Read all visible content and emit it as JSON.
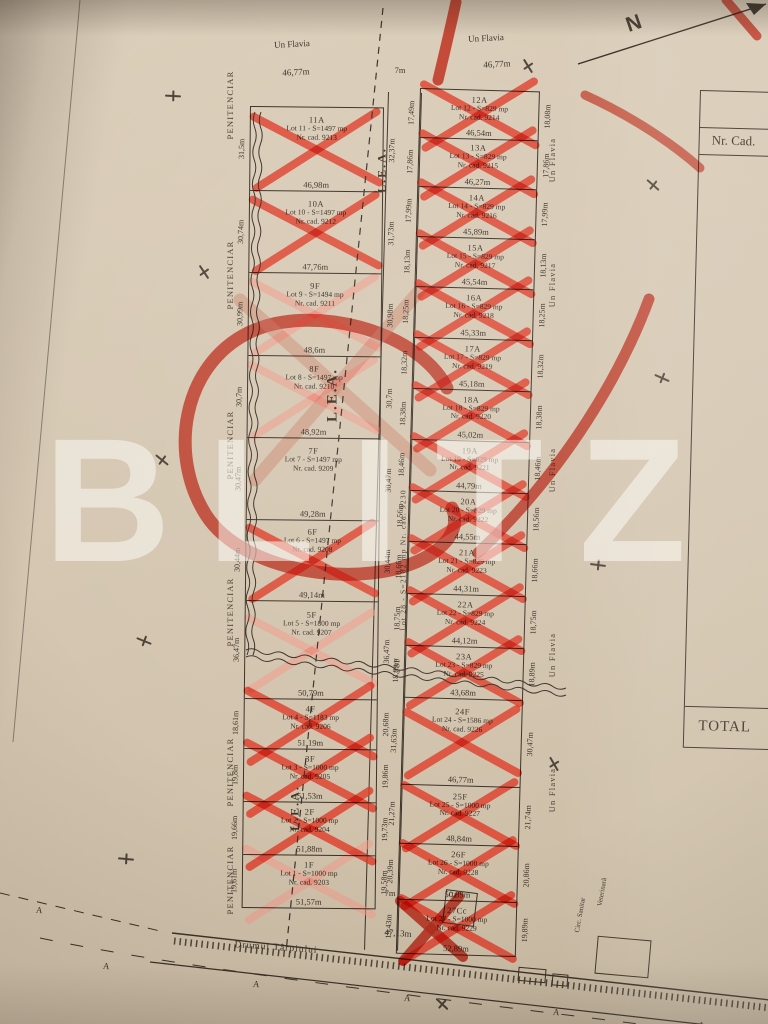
{
  "watermark": "BLITZ",
  "compass_label": "N",
  "colors": {
    "paper": "#d5c7b2",
    "ink": "#3b3127",
    "red": "#df3a28",
    "red_light": "#f29a8a"
  },
  "top": {
    "street_left": "Un Flavia",
    "street_right": "Un Flavia",
    "frontage_left": "46,77m",
    "frontage_right": "46,77m",
    "road_width_top": "7m"
  },
  "bottom": {
    "road_name": "Drumul Târpiului",
    "road_width_bottom": "7m",
    "frontage": "47,13m",
    "boundary_letter": "A",
    "building_label": "C1",
    "sanitary_label_1": "Circ. Sanitar",
    "sanitary_label_2": "Veterinară"
  },
  "margins": {
    "left_label": "PENITENCIAR",
    "right_label": "Un Flavia",
    "power_line_label": "L.E.A."
  },
  "road_lot": {
    "designation": "28F",
    "label": "Lot 28 - S=2182 mp Nr. cad. 9230"
  },
  "side_table": {
    "header": "Nr. Cad.",
    "footer": "TOTAL"
  },
  "left_column": [
    {
      "designation": "11A",
      "area": "Lot 11 - S=1497 mp",
      "cad": "Nr. cad. 9213",
      "frontage": "46,98m",
      "side_left": "31,5m",
      "side_right": "32,37m",
      "mark": "x"
    },
    {
      "designation": "10A",
      "area": "Lot 10 - S=1497 mp",
      "cad": "Nr. cad. 9212",
      "frontage": "47,76m",
      "side_left": "30,74m",
      "side_right": "31,73m",
      "mark": "x"
    },
    {
      "designation": "9F",
      "area": "Lot 9 - S=1494 mp",
      "cad": "Nr. cad. 9211",
      "frontage": "48,6m",
      "side_left": "30,99m",
      "side_right": "30,98m",
      "mark": "x-light"
    },
    {
      "designation": "8F",
      "area": "Lot 8 - S=1497 mp",
      "cad": "Nr. cad. 9210",
      "frontage": "48,92m",
      "side_left": "30,7m",
      "side_right": "30,7m",
      "mark": "x-light"
    },
    {
      "designation": "7F",
      "area": "Lot 7 - S=1497 mp",
      "cad": "Nr. cad. 9209",
      "frontage": "49,28m",
      "side_left": "30,47m",
      "side_right": "30,47m",
      "mark": "none"
    },
    {
      "designation": "6F",
      "area": "Lot 6 - S=1497 mp",
      "cad": "Nr. cad. 9208",
      "frontage": "49,14m",
      "side_left": "30,44m",
      "side_right": "30,44m",
      "mark": "x"
    },
    {
      "designation": "5F",
      "area": "Lot 5 - S=1800 mp",
      "cad": "Nr. cad. 9207",
      "frontage": "50,79m",
      "side_left": "36,47m",
      "side_right": "36,47m",
      "mark": "x-light"
    },
    {
      "designation": "4F",
      "area": "Lot 4 - S=1183 mp",
      "cad": "Nr. cad. 9206",
      "frontage": "51,19m",
      "side_left": "18,61m",
      "side_right": "20,68m",
      "mark": "x"
    },
    {
      "designation": "3F",
      "area": "Lot 3 - S=1000 mp",
      "cad": "Nr. cad. 9205",
      "frontage": "51,53m",
      "side_left": "19,8m",
      "side_right": "19,86m",
      "mark": "x"
    },
    {
      "designation": "2F",
      "area": "Lot 2 - S=1000 mp",
      "cad": "Nr. cad. 9204",
      "frontage": "51,88m",
      "side_left": "19,66m",
      "side_right": "19,73m",
      "mark": "x"
    },
    {
      "designation": "1F",
      "area": "Lot 1 - S=1000 mp",
      "cad": "Nr. cad. 9203",
      "frontage": "51,57m",
      "side_left": "19,61m",
      "side_right": "19,58m",
      "mark": "x-light"
    }
  ],
  "right_column": [
    {
      "designation": "12A",
      "area": "Lot 12 - S=829 mp",
      "cad": "Nr. cad. 9214",
      "frontage": "46,54m",
      "side_left": "17,49m",
      "side_right": "18,08m",
      "mark": "x"
    },
    {
      "designation": "13A",
      "area": "Lot 13 - S=829 mp",
      "cad": "Nr. cad. 9215",
      "frontage": "46,27m",
      "side_left": "17,86m",
      "side_right": "17,86m",
      "mark": "x"
    },
    {
      "designation": "14A",
      "area": "Lot 14 - S=829 mp",
      "cad": "Nr. cad. 9216",
      "frontage": "45,89m",
      "side_left": "17,99m",
      "side_right": "17,99m",
      "mark": "x"
    },
    {
      "designation": "15A",
      "area": "Lot 15 - S=829 mp",
      "cad": "Nr. cad. 9217",
      "frontage": "45,54m",
      "side_left": "18,13m",
      "side_right": "18,13m",
      "mark": "x"
    },
    {
      "designation": "16A",
      "area": "Lot 16 - S=829 mp",
      "cad": "Nr. cad. 9218",
      "frontage": "45,33m",
      "side_left": "18,25m",
      "side_right": "18,25m",
      "mark": "x"
    },
    {
      "designation": "17A",
      "area": "Lot 17 - S=829 mp",
      "cad": "Nr. cad. 9219",
      "frontage": "45,18m",
      "side_left": "18,32m",
      "side_right": "18,32m",
      "mark": "x"
    },
    {
      "designation": "18A",
      "area": "Lot 18 - S=829 mp",
      "cad": "Nr. cad. 9220",
      "frontage": "45,02m",
      "side_left": "18,38m",
      "side_right": "18,38m",
      "mark": "x"
    },
    {
      "designation": "19A",
      "area": "Lot 19 - S=829 mp",
      "cad": "Nr. cad. 9221",
      "frontage": "44,79m",
      "side_left": "18,46m",
      "side_right": "18,46m",
      "mark": "x"
    },
    {
      "designation": "20A",
      "area": "Lot 20 - S=829 mp",
      "cad": "Nr. cad. 9222",
      "frontage": "44,55m",
      "side_left": "18,56m",
      "side_right": "18,56m",
      "mark": "x"
    },
    {
      "designation": "21A",
      "area": "Lot 21 - S=829 mp",
      "cad": "Nr. cad. 9223",
      "frontage": "44,31m",
      "side_left": "18,66m",
      "side_right": "18,66m",
      "mark": "x"
    },
    {
      "designation": "22A",
      "area": "Lot 22 - S=829 mp",
      "cad": "Nr. cad. 9224",
      "frontage": "44,12m",
      "side_left": "18,75m",
      "side_right": "18,75m",
      "mark": "x"
    },
    {
      "designation": "23A",
      "area": "Lot 23 - S=829 mp",
      "cad": "Nr. cad. 9225",
      "frontage": "43,68m",
      "side_left": "18,89m",
      "side_right": "18,89m",
      "mark": "x"
    },
    {
      "designation": "24F",
      "area": "Lot 24 - S=1586 mp",
      "cad": "Nr. cad. 9226",
      "frontage": "46,77m",
      "side_left": "31,63m",
      "side_right": "30,47m",
      "mark": "x"
    },
    {
      "designation": "25F",
      "area": "Lot 25 - S=1000 mp",
      "cad": "Nr. cad. 9227",
      "frontage": "48,84m",
      "side_left": "21,27m",
      "side_right": "21,74m",
      "mark": "x"
    },
    {
      "designation": "26F",
      "area": "Lot 26 - S=1000 mp",
      "cad": "Nr. cad. 9228",
      "frontage": "50,89m",
      "side_left": "20,39m",
      "side_right": "20,86m",
      "mark": "x"
    },
    {
      "designation": "27Cc",
      "area": "Lot 27 - S=1000 mp",
      "cad": "Nr. cad. 9229",
      "frontage": "52,89m",
      "side_left": "19,43m",
      "side_right": "19,89m",
      "mark": "x"
    }
  ]
}
